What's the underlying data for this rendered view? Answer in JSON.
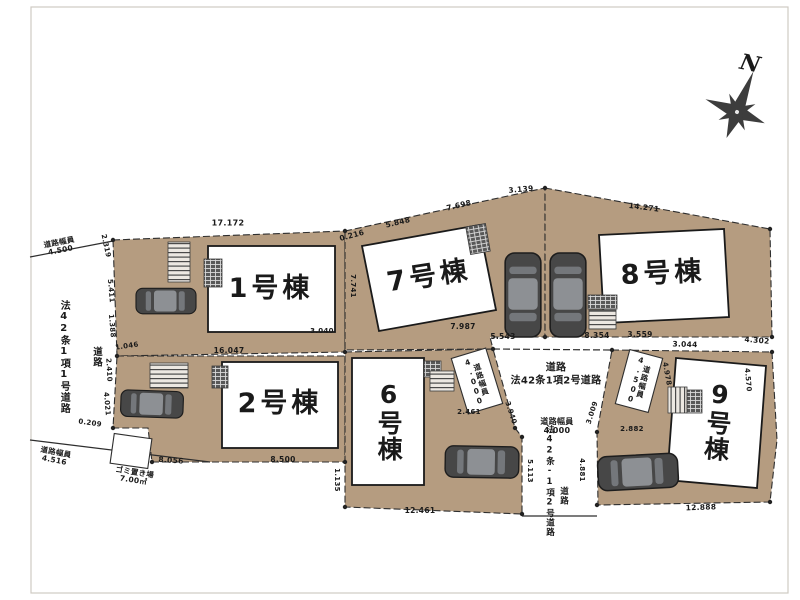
{
  "meta": {
    "type": "real-estate-site-plan",
    "units": "m"
  },
  "colors": {
    "lot": "#b59c80",
    "line": "#2e2e2e",
    "building": "#ffffff",
    "car_body": "#474747",
    "text": "#1a1a1a"
  },
  "plan": {
    "compass_label": "N",
    "buildings": [
      {
        "id": 1,
        "label": "1号棟"
      },
      {
        "id": 2,
        "label": "2号棟"
      },
      {
        "id": 6,
        "label": "6号棟"
      },
      {
        "id": 7,
        "label": "7号棟"
      },
      {
        "id": 8,
        "label": "8号棟"
      },
      {
        "id": 9,
        "label": "9号棟"
      }
    ],
    "labels": [
      {
        "name": "building-1-label",
        "text": "1号棟",
        "x": 271,
        "y": 289,
        "size": 27,
        "cls": "bldg"
      },
      {
        "name": "building-2-label",
        "text": "2号棟",
        "x": 280,
        "y": 404,
        "size": 27,
        "cls": "bldg"
      },
      {
        "name": "building-6-label",
        "text": "6号棟",
        "x": 388,
        "y": 421,
        "size": 25,
        "cls": "bldg",
        "vertical": true
      },
      {
        "name": "building-7-label",
        "text": "7号棟",
        "x": 429,
        "y": 277,
        "size": 27,
        "rot": -9,
        "cls": "bldg"
      },
      {
        "name": "building-8-label",
        "text": "8号棟",
        "x": 663,
        "y": 274,
        "size": 27,
        "rot": -3,
        "cls": "bldg"
      },
      {
        "name": "building-9-label",
        "text": "9号棟",
        "x": 717,
        "y": 421,
        "size": 25,
        "rot": 5,
        "cls": "bldg",
        "vertical": true
      },
      {
        "name": "north-label",
        "text": "N",
        "x": 750,
        "y": 64,
        "size": 22,
        "rot": 12,
        "cls": "north"
      },
      {
        "name": "left-road-width-top",
        "text": "道路幅員\n4.500",
        "x": 60,
        "y": 247,
        "rot": -11,
        "size": 7.5
      },
      {
        "name": "left-road-name",
        "text": "法42条1項1号道路",
        "x": 63,
        "y": 357,
        "size": 10,
        "vertical": true
      },
      {
        "name": "left-road-label",
        "text": "道路",
        "x": 96,
        "y": 357,
        "size": 9.5,
        "vertical": true
      },
      {
        "name": "left-road-width-bottom",
        "text": "道路幅員\n4.516",
        "x": 55,
        "y": 457,
        "rot": 11,
        "size": 7.5
      },
      {
        "name": "garbage-area-label",
        "text": "ゴミ置き場\n7.00㎡",
        "x": 134,
        "y": 477,
        "rot": 9,
        "size": 7.5
      },
      {
        "name": "central-road-label",
        "text": "道路",
        "x": 556,
        "y": 368,
        "size": 10
      },
      {
        "name": "central-road-name",
        "text": "法42条1項2号道路",
        "x": 556,
        "y": 381,
        "size": 10
      },
      {
        "name": "central-road-width",
        "text": "道路幅員\n4.000",
        "x": 557,
        "y": 427,
        "size": 8
      },
      {
        "name": "west-road-width-box-label",
        "text": "道路幅員\n4.000",
        "x": 477,
        "y": 381,
        "rot": -17,
        "size": 7.5,
        "vertical": true
      },
      {
        "name": "east-road-width-box-label",
        "text": "道路幅員\n4.500",
        "x": 639,
        "y": 381,
        "rot": 15,
        "size": 7.5,
        "vertical": true
      },
      {
        "name": "south-road-name",
        "text": "法42条-1項2号道路",
        "x": 549,
        "y": 481,
        "size": 8.5,
        "vertical": true
      },
      {
        "name": "south-road-label",
        "text": "道路",
        "x": 563,
        "y": 496,
        "size": 8.5,
        "vertical": true
      },
      {
        "name": "dim-17172",
        "text": "17.172",
        "x": 228,
        "y": 224,
        "size": 8
      },
      {
        "name": "dim-0216",
        "text": "0.216",
        "x": 352,
        "y": 236,
        "rot": -15,
        "size": 7.5
      },
      {
        "name": "dim-5848",
        "text": "5.848",
        "x": 398,
        "y": 223,
        "rot": -13,
        "size": 7.5
      },
      {
        "name": "dim-7698",
        "text": "7.698",
        "x": 459,
        "y": 206,
        "rot": -13,
        "size": 7.5
      },
      {
        "name": "dim-3139",
        "text": "3.139",
        "x": 521,
        "y": 190,
        "rot": -5,
        "size": 7.5
      },
      {
        "name": "dim-14271",
        "text": "14.271",
        "x": 644,
        "y": 208,
        "rot": 7,
        "size": 7.5
      },
      {
        "name": "dim-4302",
        "text": "4.302",
        "x": 757,
        "y": 341,
        "rot": 5,
        "size": 7.5
      },
      {
        "name": "dim-3044",
        "text": "3.044",
        "x": 685,
        "y": 345,
        "rot": 2,
        "size": 7.5
      },
      {
        "name": "dim-3559",
        "text": "3.559",
        "x": 640,
        "y": 335,
        "size": 7.5
      },
      {
        "name": "dim-8354",
        "text": "8.354",
        "x": 597,
        "y": 336,
        "size": 7.5
      },
      {
        "name": "dim-5543",
        "text": "5.543",
        "x": 503,
        "y": 337,
        "size": 7.5
      },
      {
        "name": "dim-7987",
        "text": "7.987",
        "x": 463,
        "y": 327,
        "size": 7.5
      },
      {
        "name": "dim-16047",
        "text": "16.047",
        "x": 229,
        "y": 351,
        "size": 7.5
      },
      {
        "name": "dim-1046",
        "text": "1.046",
        "x": 127,
        "y": 347,
        "rot": -8,
        "size": 7
      },
      {
        "name": "dim-3040",
        "text": "3.040",
        "x": 322,
        "y": 332,
        "size": 7
      },
      {
        "name": "dim-8056",
        "text": "8.056",
        "x": 171,
        "y": 461,
        "rot": 4,
        "size": 7.5
      },
      {
        "name": "dim-8500",
        "text": "8.500",
        "x": 283,
        "y": 460,
        "size": 7.5
      },
      {
        "name": "dim-12461",
        "text": "12.461",
        "x": 420,
        "y": 511,
        "size": 7.5
      },
      {
        "name": "dim-12888",
        "text": "12.888",
        "x": 701,
        "y": 508,
        "rot": -2,
        "size": 7.5
      },
      {
        "name": "dim-2882",
        "text": "2.882",
        "x": 632,
        "y": 430,
        "size": 7
      },
      {
        "name": "dim-2461",
        "text": "2.461",
        "x": 469,
        "y": 413,
        "size": 7
      },
      {
        "name": "dim-3940",
        "text": "3.940",
        "x": 510,
        "y": 413,
        "rot": 72,
        "size": 7
      },
      {
        "name": "dim-3009",
        "text": "3.009",
        "x": 593,
        "y": 413,
        "rot": -72,
        "size": 7
      },
      {
        "name": "dim-5113",
        "text": "5.113",
        "x": 529,
        "y": 471,
        "rot": 90,
        "size": 7
      },
      {
        "name": "dim-4881",
        "text": "4.881",
        "x": 581,
        "y": 470,
        "rot": 90,
        "size": 7
      },
      {
        "name": "dim-4978",
        "text": "4.978",
        "x": 666,
        "y": 374,
        "rot": 80,
        "size": 7
      },
      {
        "name": "dim-4570",
        "text": "4.570",
        "x": 747,
        "y": 380,
        "rot": 85,
        "size": 7
      },
      {
        "name": "dim-2319",
        "text": "2.319",
        "x": 105,
        "y": 246,
        "rot": 78,
        "size": 7
      },
      {
        "name": "dim-5411",
        "text": "5.411",
        "x": 110,
        "y": 291,
        "rot": 85,
        "size": 7
      },
      {
        "name": "dim-1388",
        "text": "1.388",
        "x": 111,
        "y": 326,
        "rot": 85,
        "size": 7
      },
      {
        "name": "dim-2410",
        "text": "2.410",
        "x": 108,
        "y": 370,
        "rot": 87,
        "size": 7
      },
      {
        "name": "dim-4021",
        "text": "4.021",
        "x": 106,
        "y": 404,
        "rot": 85,
        "size": 7
      },
      {
        "name": "dim-0209",
        "text": "0.209",
        "x": 90,
        "y": 424,
        "rot": 8,
        "size": 7
      },
      {
        "name": "dim-1135",
        "text": "1.135",
        "x": 336,
        "y": 480,
        "rot": 90,
        "size": 7
      },
      {
        "name": "dim-7741",
        "text": "7.741",
        "x": 352,
        "y": 286,
        "rot": 90,
        "size": 7
      }
    ]
  }
}
